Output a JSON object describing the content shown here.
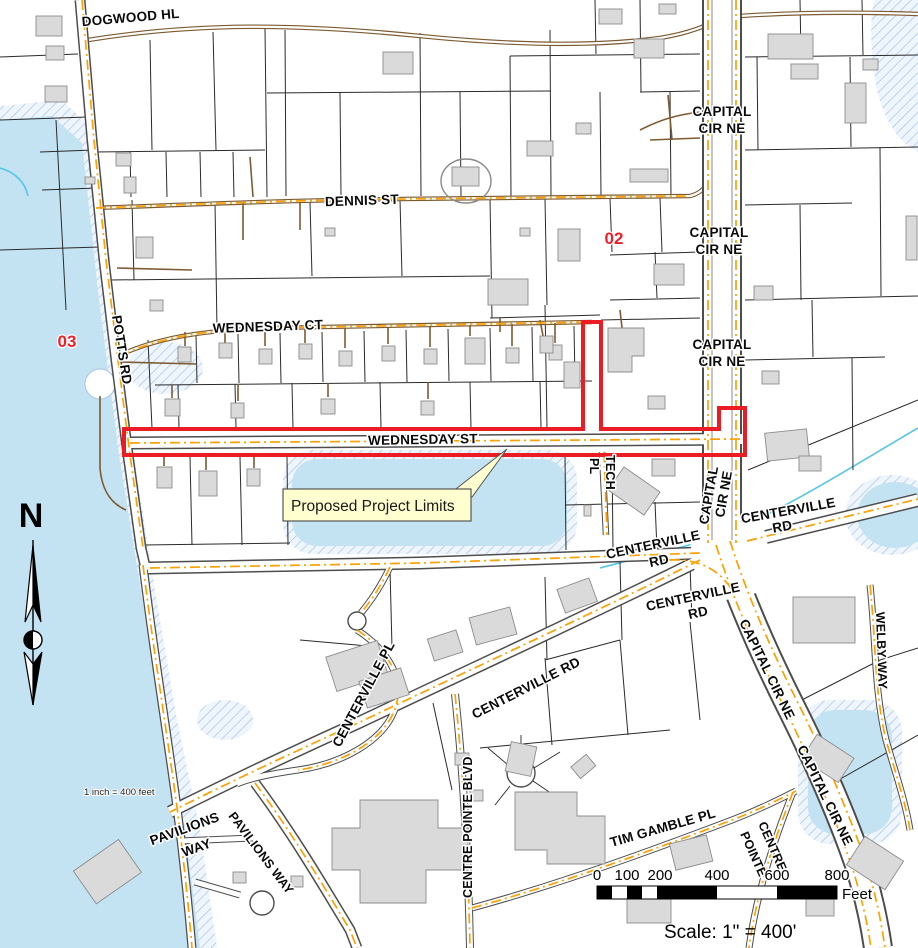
{
  "map": {
    "street_labels": {
      "dogwood_hl": "DOGWOOD HL",
      "dennis_st": "DENNIS ST",
      "capital": "CAPITAL",
      "cir_ne": "CIR NE",
      "capital_cir_ne": "CAPITAL CIR NE",
      "potts_rd": "POTTS RD",
      "wednesday_ct": "WEDNESDAY CT",
      "wednesday_st": "WEDNESDAY ST",
      "tech": "TECH",
      "pl": "PL",
      "centerville": "CENTERVILLE",
      "rd": "RD",
      "centerville_rd": "CENTERVILLE RD",
      "centerville_pl": "CENTERVILLE PL",
      "centre_pointe_blvd": "CENTRE POINTE BLVD",
      "pavilions": "PAVILIONS",
      "way": "WAY",
      "pavilions_way": "PAVILIONS WAY",
      "tim_gamble_pl": "TIM GAMBLE PL",
      "centre": "CENTRE",
      "pointe": "POINTE",
      "welby_way": "WELBY WAY"
    },
    "sheet_refs": {
      "ref_02": "02",
      "ref_03": "03"
    },
    "callout": {
      "label": "Proposed Project Limits"
    },
    "north": {
      "label": "N"
    },
    "scale_note": "1 inch = 400 feet",
    "scale_bar": {
      "ticks": [
        "0",
        "100",
        "200",
        "400",
        "600",
        "800"
      ],
      "unit": "Feet"
    },
    "caption": "Scale: 1\" = 400'",
    "colors": {
      "water": "#c3e3f3",
      "wetland_hatch": "#a9c3e6",
      "stream": "#55c5ea",
      "building": "#dadada",
      "road_centerline": "#ffa000",
      "minor_road": "#7d5a30",
      "project_boundary": "#ec1c24",
      "callout_fill": "#ffffd0"
    }
  }
}
